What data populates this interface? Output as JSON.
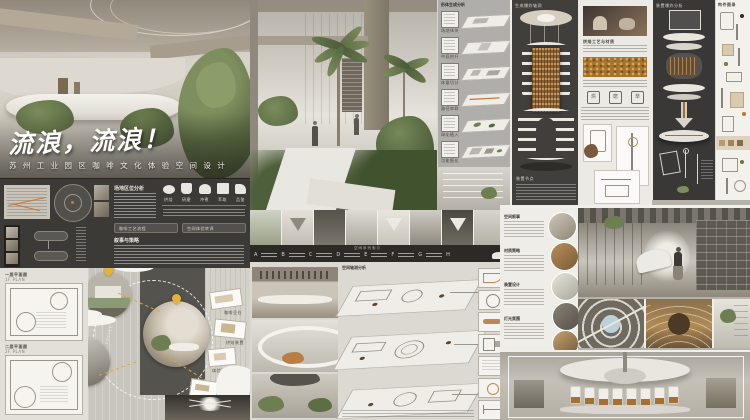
{
  "poster": {
    "hero": {
      "title": "流浪，流浪！",
      "subtitle": "苏 州 工 业 园 区 咖 啡 文 化 体 验 空 间 设 计"
    },
    "info": {
      "site_heading": "场地区位分析",
      "narrative_heading": "叙事与策略",
      "icons": [
        {
          "label": "烘焙"
        },
        {
          "label": "研磨"
        },
        {
          "label": "冲煮"
        },
        {
          "label": "萃取"
        },
        {
          "label": "品鉴"
        }
      ],
      "tag1": "咖啡工艺流程",
      "tag2": "空间体验转译"
    },
    "gen": {
      "header": "形体生成分析",
      "steps": [
        {
          "num": "①",
          "label": "场地体块"
        },
        {
          "num": "②",
          "label": "中庭抬升"
        },
        {
          "num": "③",
          "label": "体量切分"
        },
        {
          "num": "④",
          "label": "路径串联"
        },
        {
          "num": "⑤",
          "label": "绿化植入"
        },
        {
          "num": "⑥",
          "label": "功能细化"
        }
      ]
    },
    "timeline": {
      "title": "空间序列索引",
      "letters": [
        "A",
        "B",
        "C",
        "D",
        "E",
        "F",
        "G",
        "H"
      ]
    },
    "plans": {
      "p1_label": "一层平面图",
      "p1_sub": "1F PLAN",
      "p2_label": "二层平面图",
      "p2_sub": "2F PLAN"
    },
    "journey": {
      "arc_label": "WANDERING COFFEE CULTURE LINE",
      "tags": [
        "咖啡豆仓",
        "烘焙装置",
        "体验剧场",
        "观演空间"
      ]
    },
    "axon": {
      "header": "空间轴测分析"
    },
    "tower": {
      "label": "生成爆炸轴测",
      "note": "装置节点"
    },
    "roaster": {
      "caption": "烘焙工艺与材质",
      "icons": [
        "烘",
        "磨",
        "萃"
      ]
    },
    "explode": {
      "label": "装置爆炸分析"
    },
    "parts": {
      "header": "构件图录"
    },
    "notes": {
      "sections": [
        "空间叙事",
        "材质策略",
        "装置设计",
        "灯光氛围"
      ]
    }
  }
}
